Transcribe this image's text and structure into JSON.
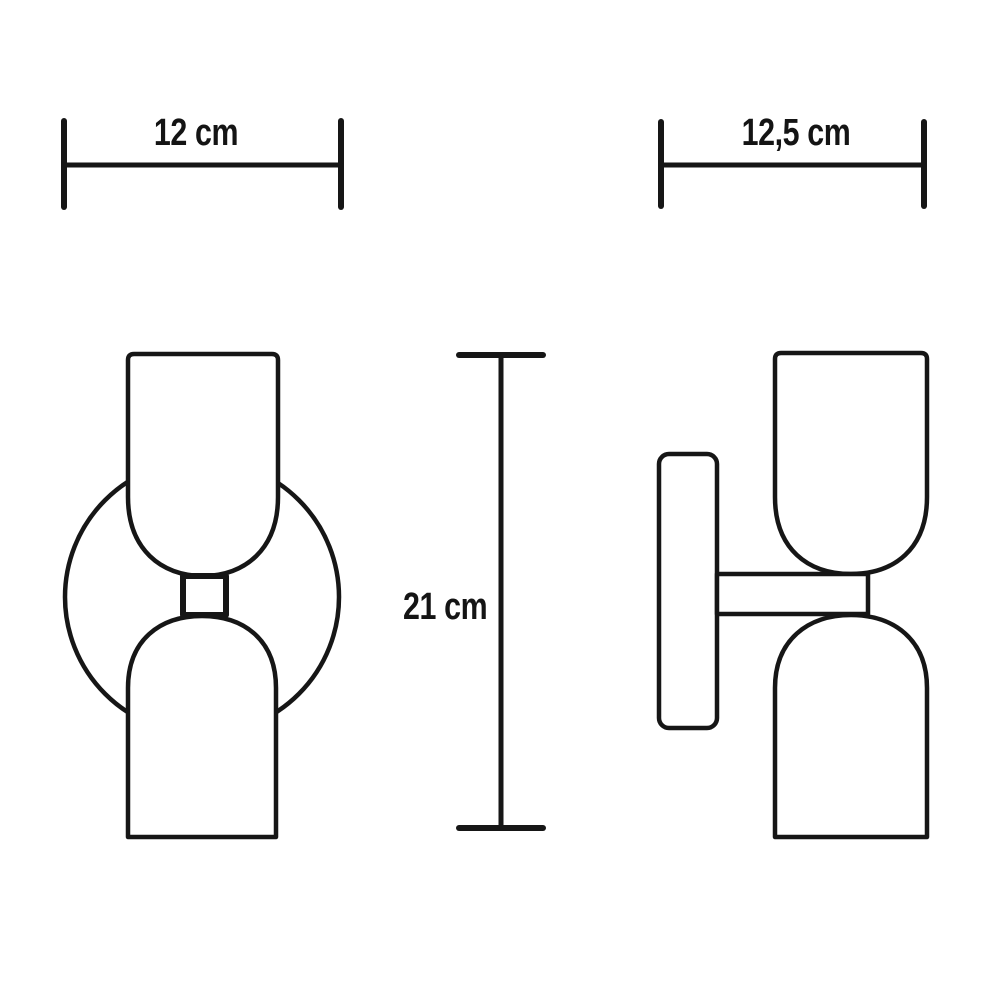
{
  "page": {
    "background": "#ffffff",
    "line_color": "#161616"
  },
  "dimensions": {
    "front_width": {
      "label": "12 cm",
      "value_cm": 12
    },
    "side_depth": {
      "label": "12,5 cm",
      "value_cm": 12.5
    },
    "height": {
      "label": "21 cm",
      "value_cm": 21
    }
  },
  "views": {
    "front": "front view",
    "side": "side view"
  }
}
